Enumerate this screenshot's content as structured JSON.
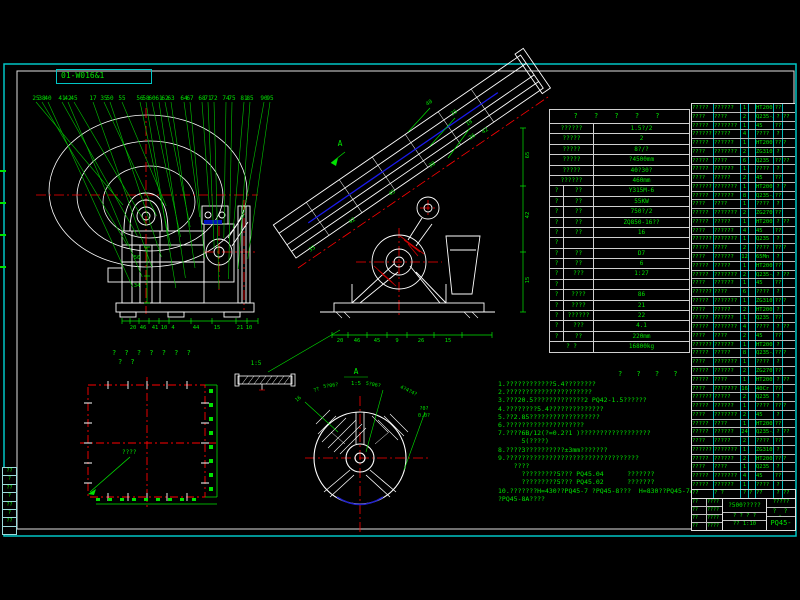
{
  "frame": {
    "sheet_code": "01-W016&1"
  },
  "front_view": {
    "part_labels": [
      "25",
      "38",
      "40",
      "41",
      "42",
      "45",
      "17",
      "35",
      "50",
      "55",
      "56",
      "58",
      "60",
      "61",
      "62",
      "63",
      "64",
      "67",
      "68",
      "71",
      "72",
      "74",
      "75",
      "81",
      "85",
      "90",
      "95"
    ],
    "bottom_dims": [
      "20",
      "46",
      "41",
      "10",
      "4",
      "44",
      "15",
      "21",
      "10"
    ],
    "inner_dims": [
      "50",
      "34"
    ]
  },
  "section_view": {
    "marker": "A",
    "edge_labels": [
      "35",
      "42",
      "45",
      "38",
      "26"
    ],
    "top_labels": [
      "40",
      "35",
      "18",
      "42"
    ],
    "bottom_dims": [
      "20",
      "46",
      "45",
      "9",
      "26",
      "15"
    ],
    "right_dims": [
      "65",
      "42",
      "15"
    ]
  },
  "plan_view": {
    "title": "? ? ? ? ? ? ?",
    "subtitle": "? ?",
    "leader_label": "????"
  },
  "flywheel_view": {
    "marker": "A",
    "scale": "1:5",
    "labels": [
      "16",
      "??",
      "5?06?",
      "5?06?",
      "4?4?4?",
      "?0?",
      "0.0?"
    ]
  },
  "detail_view": {
    "scale": "1:5"
  },
  "notes": {
    "header": "? ? ? ?",
    "lines": [
      "1.????????????5.4????????",
      "2.??????????????????????",
      "3.???20.5?????????????2 PQ42-1.5??????",
      "4.????????5.4??????????????",
      "5.??2.85??????????????????",
      "6.????????????????????",
      "7.????6B/12(?=0.2?1 )??????????????????",
      "      5(????)",
      "8.????3??????????±3mm???????",
      "9.??????????????????????????????????",
      "    ????",
      "      ?????????5??? PQ45.04      ???????",
      "      ?????????5??? PQ45.02      ???????",
      "10.???????H=430??PQ45-7 ?PQ45-8???  H=830??PQ45-7A",
      "?PQ45-8A????"
    ]
  },
  "param_table": {
    "title": "? ? ? ? ?",
    "rows": [
      {
        "k": "t2",
        "c": [
          "??????",
          "1.5?/2"
        ]
      },
      {
        "k": "t2",
        "c": [
          "?????",
          "2"
        ]
      },
      {
        "k": "t2",
        "c": [
          "?????",
          "8?/?"
        ]
      },
      {
        "k": "t2",
        "c": [
          "?????",
          "?4500mm"
        ]
      },
      {
        "k": "t2",
        "c": [
          "?????",
          "40?30?"
        ]
      },
      {
        "k": "t2",
        "c": [
          "??????",
          "460mm"
        ]
      },
      {
        "k": "t3",
        "c": [
          "?",
          "??",
          "Y315M-6"
        ]
      },
      {
        "k": "t3",
        "c": [
          "?",
          "??",
          "55KW"
        ]
      },
      {
        "k": "t3",
        "c": [
          "?",
          "??",
          "750?/2"
        ]
      },
      {
        "k": "t3",
        "c": [
          "?",
          "??",
          "ZQ850-16??"
        ]
      },
      {
        "k": "t3",
        "c": [
          "?",
          "??",
          "16"
        ]
      },
      {
        "k": "sp",
        "c": [
          "?",
          "",
          ""
        ]
      },
      {
        "k": "t3",
        "c": [
          "?",
          "??",
          "D7"
        ]
      },
      {
        "k": "t3",
        "c": [
          "?",
          "??",
          "6"
        ]
      },
      {
        "k": "t3",
        "c": [
          "?",
          "???",
          "1:27"
        ]
      },
      {
        "k": "sp",
        "c": [
          "?",
          "",
          ""
        ]
      },
      {
        "k": "t3",
        "c": [
          "?",
          "????",
          "86"
        ]
      },
      {
        "k": "t3",
        "c": [
          "?",
          "????",
          "21"
        ]
      },
      {
        "k": "t3",
        "c": [
          "?",
          "??????",
          "22"
        ]
      },
      {
        "k": "t3",
        "c": [
          "?",
          "???",
          "4.1"
        ]
      },
      {
        "k": "t3",
        "c": [
          "?",
          "??",
          "220mm"
        ]
      },
      {
        "k": "tt",
        "c": [
          "? ?",
          "16800kg"
        ]
      }
    ]
  },
  "bom": {
    "header": [
      "??",
      "? ?",
      "?",
      "?",
      "??",
      "?",
      "??"
    ],
    "rows": [
      [
        "?????",
        "??????",
        "1",
        "",
        "HT200",
        "??",
        ""
      ],
      [
        "????",
        "????",
        "2",
        "",
        "Q235-A",
        "?",
        "??"
      ],
      [
        "?????",
        "???????",
        "1",
        "",
        "45",
        "??",
        ""
      ],
      [
        "??????",
        "?????",
        "4",
        "",
        "????",
        "?",
        ""
      ],
      [
        "?????",
        "??????",
        "1",
        "",
        "HT200",
        "??",
        "?"
      ],
      [
        "????",
        "???????",
        "2",
        "",
        "ZG310",
        "?",
        ""
      ],
      [
        "?????",
        "????",
        "6",
        "",
        "Q235",
        "??",
        "??"
      ],
      [
        "?????",
        "??????",
        "1",
        "",
        "????",
        "?",
        ""
      ],
      [
        "????",
        "?????",
        "2",
        "",
        "45",
        "??",
        ""
      ],
      [
        "??????",
        "???????",
        "1",
        "",
        "HT200",
        "?",
        "?"
      ],
      [
        "?????",
        "??????",
        "8",
        "",
        "Q235-A",
        "??",
        ""
      ],
      [
        "????",
        "????",
        "1",
        "",
        "????",
        "?",
        ""
      ],
      [
        "?????",
        "???????",
        "2",
        "",
        "ZG270",
        "??",
        ""
      ],
      [
        "?????",
        "?????",
        "1",
        "",
        "HT200",
        "?",
        "??"
      ],
      [
        "????",
        "??????",
        "4",
        "",
        "45",
        "??",
        ""
      ],
      [
        "??????",
        "???????",
        "1",
        "",
        "Q235",
        "?",
        ""
      ],
      [
        "?????",
        "????",
        "2",
        "",
        "????",
        "??",
        "?"
      ],
      [
        "????",
        "??????",
        "12",
        "",
        "65Mn",
        "?",
        ""
      ],
      [
        "?????",
        "?????",
        "1",
        "",
        "HT200",
        "??",
        ""
      ],
      [
        "?????",
        "???????",
        "2",
        "",
        "Q235-A",
        "?",
        "??"
      ],
      [
        "????",
        "??????",
        "1",
        "",
        "45",
        "??",
        ""
      ],
      [
        "??????",
        "????",
        "6",
        "",
        "????",
        "?",
        ""
      ],
      [
        "?????",
        "???????",
        "1",
        "",
        "ZG310",
        "??",
        "?"
      ],
      [
        "????",
        "?????",
        "2",
        "",
        "HT200",
        "?",
        ""
      ],
      [
        "?????",
        "??????",
        "1",
        "",
        "Q235",
        "??",
        ""
      ],
      [
        "?????",
        "???????",
        "4",
        "",
        "????",
        "?",
        "??"
      ],
      [
        "????",
        "????",
        "2",
        "",
        "45",
        "??",
        ""
      ],
      [
        "??????",
        "??????",
        "1",
        "",
        "HT200",
        "?",
        ""
      ],
      [
        "?????",
        "?????",
        "8",
        "",
        "Q235-A",
        "??",
        "?"
      ],
      [
        "????",
        "???????",
        "1",
        "",
        "????",
        "?",
        ""
      ],
      [
        "?????",
        "??????",
        "2",
        "",
        "ZG270",
        "??",
        ""
      ],
      [
        "?????",
        "????",
        "1",
        "",
        "HT200",
        "?",
        "??"
      ],
      [
        "????",
        "???????",
        "16",
        "",
        "40Cr",
        "??",
        ""
      ],
      [
        "??????",
        "?????",
        "2",
        "",
        "Q235",
        "?",
        ""
      ],
      [
        "?????",
        "??????",
        "1",
        "",
        "????",
        "??",
        "?"
      ],
      [
        "????",
        "???????",
        "2",
        "",
        "45",
        "?",
        ""
      ],
      [
        "?????",
        "????",
        "1",
        "",
        "HT200",
        "??",
        ""
      ],
      [
        "?????",
        "??????",
        "24",
        "",
        "Q235-A",
        "?",
        "??"
      ],
      [
        "????",
        "?????",
        "2",
        "",
        "????",
        "??",
        ""
      ],
      [
        "??????",
        "???????",
        "1",
        "",
        "ZG310",
        "?",
        ""
      ],
      [
        "?????",
        "??????",
        "2",
        "",
        "HT200",
        "??",
        "?"
      ],
      [
        "????",
        "????",
        "1",
        "",
        "Q235",
        "?",
        ""
      ],
      [
        "?????",
        "???????",
        "4",
        "",
        "45",
        "??",
        ""
      ],
      [
        "?????",
        "??????",
        "1",
        "",
        "????",
        "?",
        ""
      ]
    ]
  },
  "title_block": {
    "sign_rows": [
      [
        "??",
        "????"
      ],
      [
        "??",
        "????"
      ],
      [
        "??",
        "????"
      ],
      [
        "??",
        "????"
      ]
    ],
    "title": "?500?????",
    "sub": "? ? ? ?",
    "scale": "?? 1:10",
    "org": "?????",
    "mid": "? ? ?",
    "number": "PQ45-0B"
  },
  "edge_strip": {
    "cells": [
      "??",
      "?",
      "??",
      "?",
      "??",
      "?",
      "??",
      ""
    ]
  }
}
